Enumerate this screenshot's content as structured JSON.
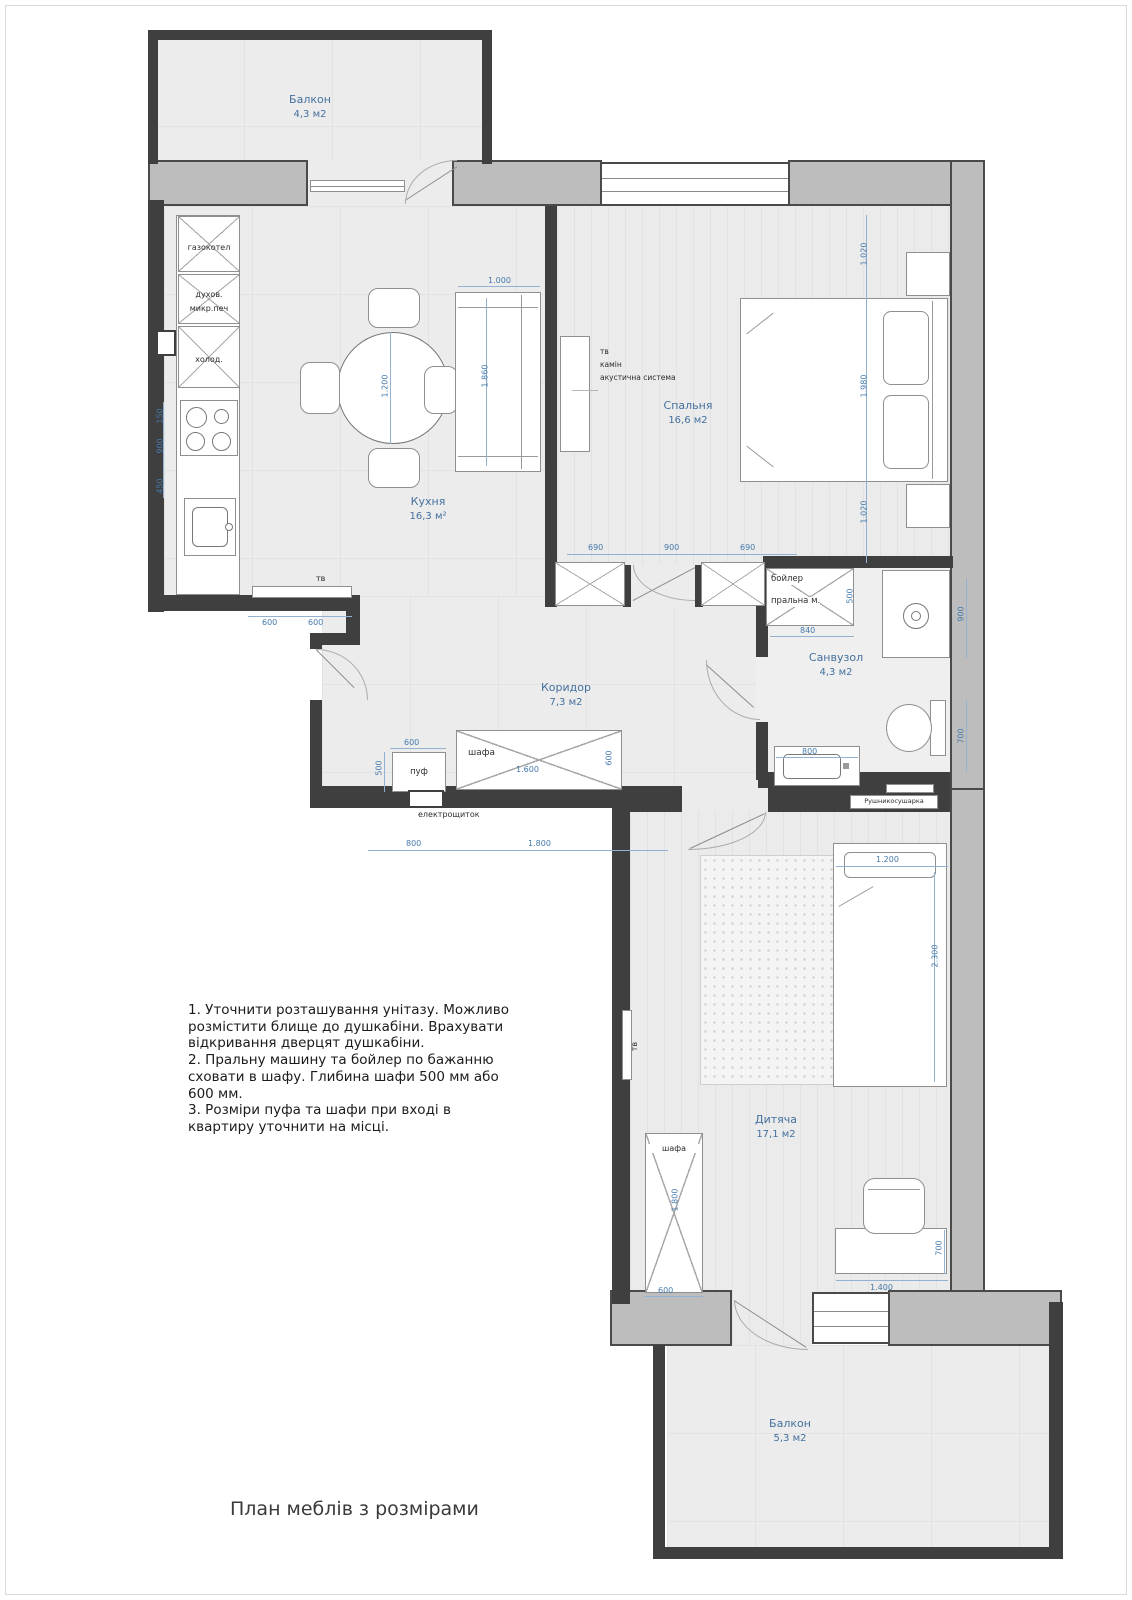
{
  "title": "План меблів з розмірами",
  "rooms": {
    "balcony_top": {
      "name": "Балкон",
      "area": "4,3 м2"
    },
    "kitchen": {
      "name": "Кухня",
      "area": "16,3 м²"
    },
    "bedroom": {
      "name": "Спальня",
      "area": "16,6 м2"
    },
    "bathroom": {
      "name": "Санвузол",
      "area": "4,3 м2"
    },
    "corridor": {
      "name": "Коридор",
      "area": "7,3 м2"
    },
    "kids": {
      "name": "Дитяча",
      "area": "17,1 м2"
    },
    "balcony_bottom": {
      "name": "Балкон",
      "area": "5,3 м2"
    }
  },
  "labels": {
    "gas_boiler": "газокотел",
    "oven": "духов.",
    "microwave": "микр.печ",
    "fridge": "холод.",
    "kitchen_tv": "тв",
    "tv": "тв",
    "fireplace": "камін",
    "acoustic": "акустична система",
    "boiler": "бойлер",
    "washer": "пральна м.",
    "towel_dryer": "Рушникосушарка",
    "hall_wardrobe": "шафа",
    "pouf": "пуф",
    "electrical_panel": "електрощиток",
    "kids_wardrobe": "шафа",
    "kids_tv": "тв"
  },
  "dims": {
    "sofa_w": "1.000",
    "sofa_l": "1.860",
    "table_d": "1.200",
    "k_left_1": "150",
    "k_left_2": "900",
    "k_left_3": "450",
    "k_bottom_1": "600",
    "k_bottom_2": "600",
    "bed_r_1": "1.020",
    "bed_r_2": "1.980",
    "bed_r_3": "1.020",
    "bed_b_1": "690",
    "bed_b_2": "900",
    "bed_b_3": "690",
    "boiler_w": "840",
    "boiler_d": "500",
    "shower_h": "900",
    "toilet_h": "700",
    "vanity_w": "800",
    "pouf_w": "600",
    "pouf_d": "500",
    "wardrobe_w": "1.600",
    "wardrobe_d": "600",
    "hall_1": "800",
    "hall_2": "1.800",
    "kbed_w": "1.200",
    "kbed_l": "2.300",
    "kwardrobe_h": "1.800",
    "kwardrobe_w": "600",
    "desk_w": "1.400",
    "desk_d": "700"
  },
  "notes": {
    "n1": "1. Уточнити розташування унітазу. Можливо розмістити блище до душкабіни. Врахувати відкривання дверцят душкабіни.",
    "n2": "2. Пральну машину та бойлер по бажанню сховати в шафу. Глибина шафи 500 мм або 600 мм.",
    "n3": "3. Розміри пуфа та шафи при вході в квартиру уточнити на місці."
  }
}
